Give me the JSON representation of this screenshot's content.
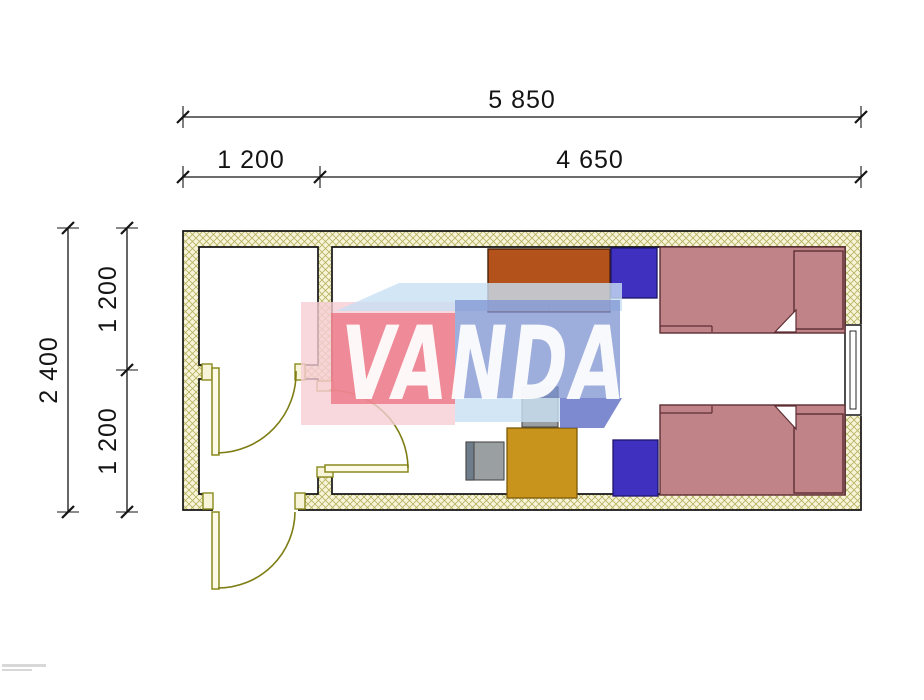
{
  "drawing": {
    "kind": "floor-plan",
    "watermark_brand": "VANDA"
  },
  "dimensions": {
    "total_width": "5 850",
    "entry_width": "1 200",
    "room_width": "4 650",
    "total_depth": "2 400",
    "depth_upper": "1 200",
    "depth_lower": "1 200"
  },
  "furniture": [
    {
      "name": "wardrobe"
    },
    {
      "name": "nightstand-top"
    },
    {
      "name": "nightstand-bottom"
    },
    {
      "name": "bed-top"
    },
    {
      "name": "bed-bottom"
    },
    {
      "name": "desk"
    },
    {
      "name": "chair-top"
    },
    {
      "name": "chair-left"
    },
    {
      "name": "window"
    },
    {
      "name": "entry-door-exterior"
    },
    {
      "name": "entry-door-interior"
    },
    {
      "name": "room-door"
    }
  ],
  "colors": {
    "ink": "#141414",
    "wall-fill": "#f8f4da",
    "hatch": "#b5b25e",
    "door": "#8a8a1e",
    "arc": "#7d7d14",
    "bed": "#c08387",
    "bed-border": "#5d2e34",
    "nightstand": "#4030bf",
    "wardrobe": "#b4521c",
    "desk": "#c9941c",
    "chair": "#9aa0a2",
    "chair-back": "#6f7d8a",
    "wm-pink": "#f6cdd4",
    "wm-red": "#eb6e7d",
    "wm-sky": "#c8e0f4",
    "wm-blue": "#8296d2",
    "wm-deep": "#5a69c3"
  }
}
